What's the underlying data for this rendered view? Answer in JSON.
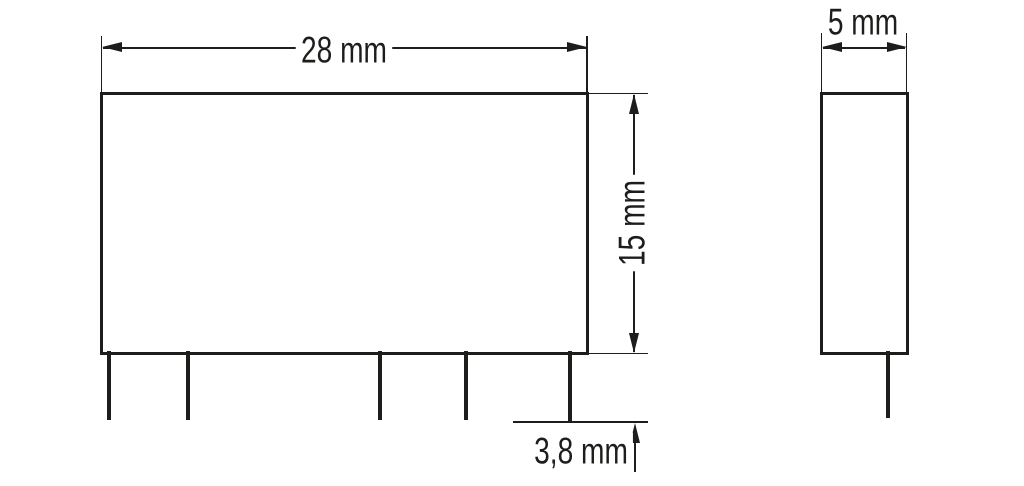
{
  "drawing": {
    "type": "technical-dimension-drawing",
    "front_view": {
      "width_dim": "28 mm",
      "height_dim": "15 mm",
      "pin_protrusion_dim": "3,8 mm",
      "pin_count": 5
    },
    "side_view": {
      "depth_dim": "5 mm",
      "pin_count": 1
    },
    "colors": {
      "ink": "#1d1d1b",
      "background": "#ffffff"
    }
  }
}
